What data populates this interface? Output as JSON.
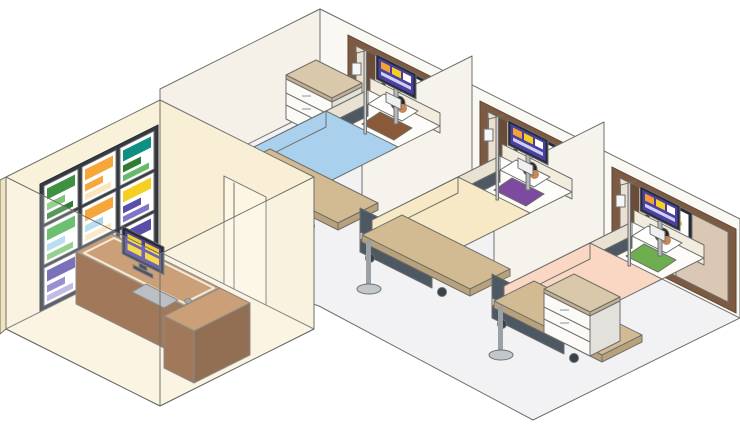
{
  "scene": {
    "type": "isometric-illustration",
    "objects": {
      "video_wall_screens": 9,
      "wall_displays": 3,
      "bedside_monitors": 3,
      "beds": 3,
      "patients": 3,
      "cabinets": 3,
      "privacy_dividers": 2,
      "desks": 1,
      "desk_monitors": 1
    }
  },
  "palette": {
    "outline": "#6f6f6c",
    "wardFloor": "#f2f2f4",
    "wardWallRight": "#faf8f3",
    "wardWallLeft": "#f6f1e8",
    "nurseWall": "#f9f1da",
    "nurseWallSide": "#f0e3bf",
    "nurseWallDoor": "#f8efd6",
    "nurseFloor": "#faf2dc",
    "doorLeaf": "#fdf6e2",
    "panelFrame": "#7d5b43",
    "panelFrameDark": "#5f4532",
    "panelInner": "#ece0d0",
    "panelInnerDark": "#dbc8b4",
    "panelStrip": "#6a4c38",
    "displayFrame": "#262b38",
    "screenWhite": "#ffffff",
    "monPurple": "#4b3fa0",
    "monOrange": "#f5a233",
    "monYellow": "#f5d020",
    "monRow": "#cdd2f5",
    "whiteBox": "#eef0f2",
    "divider": "#f6f3ec",
    "cabinetWhite": "#fbfaf7",
    "cabinetSide": "#e3e1db",
    "cabinetTop": "#d9c8a9",
    "cabinetTopSide": "#c4b190",
    "handle": "#c2c7cc",
    "bedFrame": "#f2ecdf",
    "bedRim": "#e9e2d2",
    "bedDark": "#4e5862",
    "bedDarker": "#39424a",
    "mattress": "#fdfcf8",
    "pillow": "#ffffff",
    "skin": "#c8875a",
    "hair": "#2e241d",
    "blanket1": "#a9d0ec",
    "blanket2": "#f7e9c5",
    "blanket3": "#f9d7c3",
    "shirt1": "#8a5a38",
    "shirt2": "#7c4a9e",
    "shirt3": "#6fae4e",
    "tableTop": "#d2bb93",
    "tableEdge": "#b9a27b",
    "tableLeg": "#9aa0a5",
    "tableBase": "#c2c7cc",
    "poleSilver": "#b6bac0",
    "ivPole": "#c9ced4",
    "ivBag": "#f4f6f8",
    "deskTop": "#be8756",
    "deskFront": "#8a5731",
    "deskSide": "#774a28",
    "deskTrim": "#f0e6d0",
    "keyboard": "#aab0b6",
    "mouse": "#8d9298",
    "vwFrame": "#343a44"
  },
  "video_wall": {
    "rows": 3,
    "cols": 3,
    "screens": [
      {
        "bars": [
          "#3f9142",
          "#7cc576",
          "#2e7d32"
        ]
      },
      {
        "bars": [
          "#f5a73b",
          "#f5a73b",
          "#fce4bc"
        ]
      },
      {
        "bars": [
          "#0f8f82",
          "#2e7d32",
          "#66bb6a"
        ]
      },
      {
        "bars": [
          "#4caf50",
          "#a8d8ea",
          "#7cc576"
        ]
      },
      {
        "bars": [
          "#f5a73b",
          "#a8d8ea",
          "#fce4bc"
        ]
      },
      {
        "bars": [
          "#f5d020",
          "#5b4ea8",
          "#8075c6"
        ]
      },
      {
        "bars": [
          "#5b4ea8",
          "#8075c6",
          "#b5a8e0"
        ]
      },
      {
        "bars": [
          "#6a5acd",
          "#b5499e",
          "#8075c6"
        ]
      },
      {
        "bars": [
          "#5b4ea8",
          "#f5d020",
          "#8075c6"
        ]
      }
    ]
  },
  "wall_displays": {
    "count": 3,
    "row_colors": [
      "#2f5fc4",
      "#f5c51d",
      "#5b4ea8"
    ]
  },
  "bedside_monitors": {
    "count": 3,
    "background": "#4b3fa0",
    "cells": [
      "#f5a233",
      "#f5d020",
      "#ffffff"
    ]
  },
  "desk_monitor": {
    "background": "#4b3fa0",
    "tile_color": "#f5d020",
    "tiles": 4
  },
  "beds": [
    {
      "id": "bed-1",
      "blanket": "#a9d0ec",
      "patient_shirt": "#8a5a38"
    },
    {
      "id": "bed-2",
      "blanket": "#f7e9c5",
      "patient_shirt": "#7c4a9e"
    },
    {
      "id": "bed-3",
      "blanket": "#f9d7c3",
      "patient_shirt": "#6fae4e"
    }
  ]
}
